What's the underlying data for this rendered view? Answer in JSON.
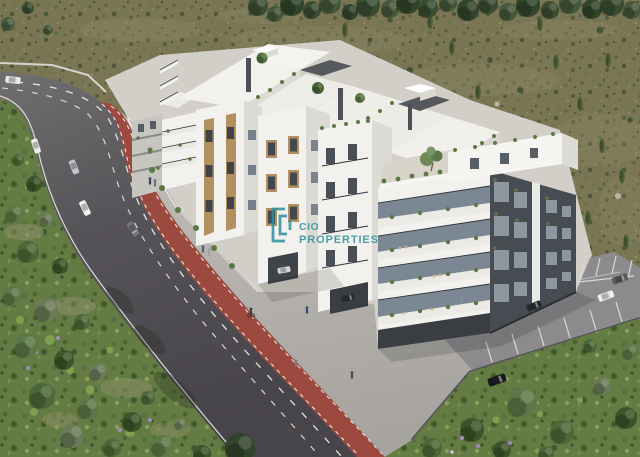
{
  "alt_text": "Aerial 3D architectural rendering of a white apartment complex with planted balconies and rooftop gardens, beside a curved road with a red cycle lane, olive-tree park, scrubland hillside and a car park, watermarked with the CIO Properties logo.",
  "brand": {
    "logo_line1": "CIO",
    "logo_line2": "PROPERTIES",
    "logo_color": "#2E8F9E"
  },
  "scene": {
    "cyclists_visible": 1,
    "pedestrians_visible": 8,
    "cars_visible": 11,
    "bike_lane_color": "red",
    "buildings_description": "white render facades with dark grey and timber accents, glass balconies, roof terraces with olive trees"
  },
  "palette": {
    "brand_teal": "#2E8F9E",
    "scrub": "#7A7654",
    "park": "#647C44",
    "road": "#565358",
    "bike_red": "#9C4A40",
    "sidewalk": "#B6B3AD",
    "parking": "#8C8A8C",
    "white_wall": "#F2F1ED",
    "shade_wall": "#DCDAD4",
    "charcoal": "#474B52",
    "wood": "#B3905F",
    "glass": "#7B8894",
    "railing": "#2F3339",
    "terrace": "#D8D4CA",
    "green_plant": "#5C7847",
    "tree_dark": "#3C5429",
    "tree_mid": "#4D6838",
    "tree_light": "#5D7847",
    "kerb_dark": "#55545A",
    "line_white": "#E4E3DF"
  }
}
